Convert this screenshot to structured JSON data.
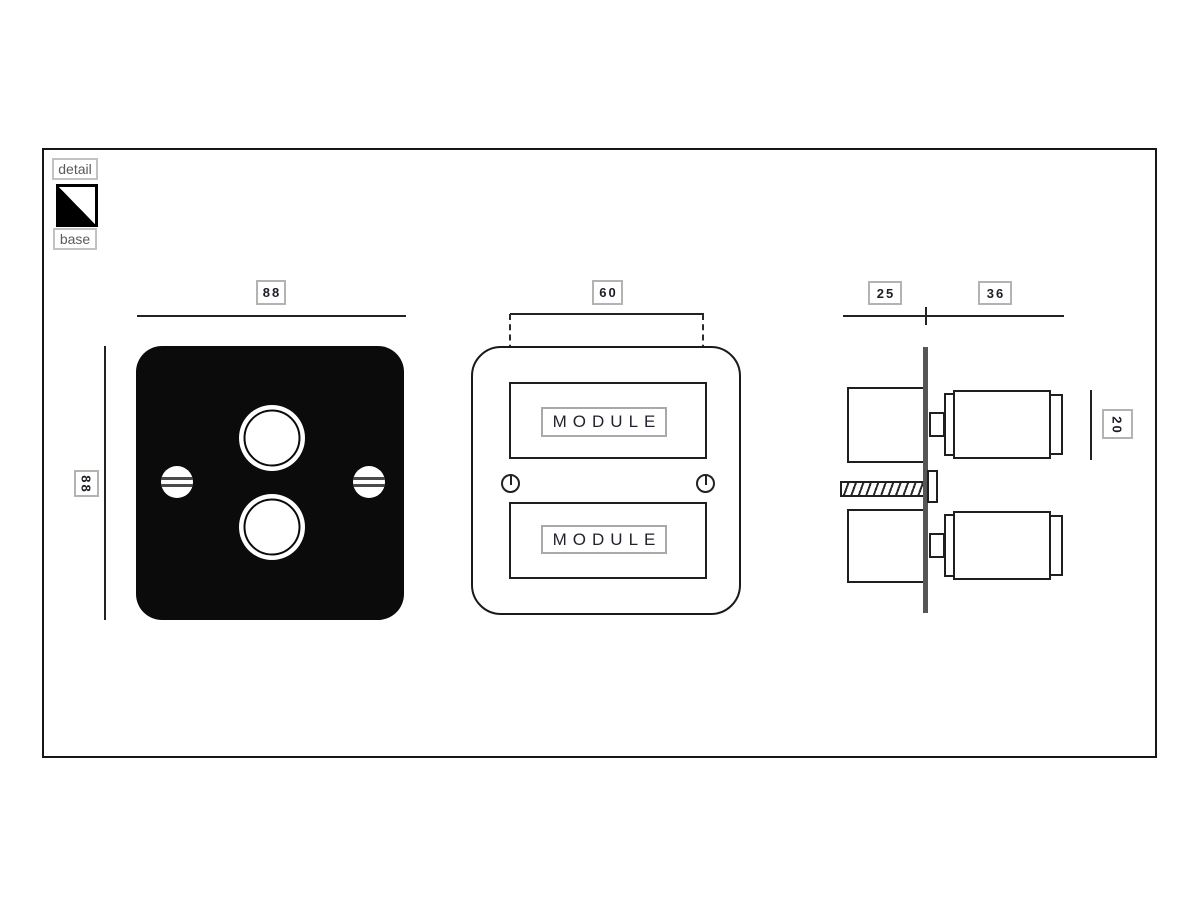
{
  "legend": {
    "detail": "detail",
    "base": "base"
  },
  "views": {
    "front": {
      "width_dim": "88",
      "height_dim": "88"
    },
    "face": {
      "module_spacing_dim": "60",
      "modules": [
        "MODULE",
        "MODULE"
      ]
    },
    "side": {
      "back_depth_dim": "25",
      "front_depth_dim": "36",
      "knob_dim": "20"
    }
  },
  "colors": {
    "plate_fill": "#0b0b0b",
    "line": "#1f1f1f",
    "label_border": "#b3b3b3",
    "label_text": "#1d1d28",
    "muted_text": "#5a5a5a",
    "side_plate_fill": "#565656"
  }
}
